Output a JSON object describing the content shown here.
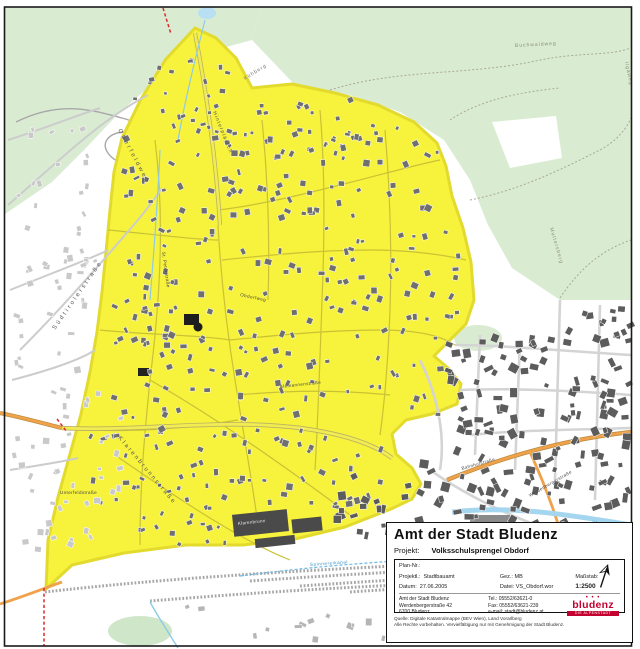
{
  "map": {
    "colors": {
      "district_fill": "#f7f23c",
      "district_border": "#e3da2e",
      "forest_green": "#d9ecd2",
      "building_dark": "#5c5c5c",
      "building_mid": "#6f6f6f",
      "building_light": "#c9c9c9",
      "main_road_orange": "#efa24a",
      "water_blue": "#a5d6ef",
      "boundary_red": "#dd2a2a"
    },
    "labels": [
      {
        "text": "Oberfeldweg",
        "x": 118,
        "y": 130,
        "r": 62,
        "s": 6,
        "sp": 2.5,
        "c": "#555"
      },
      {
        "text": "Hinterplärsch",
        "x": 213,
        "y": 112,
        "r": 68,
        "s": 5,
        "sp": 1.2,
        "c": "#555"
      },
      {
        "text": "Kühberg",
        "x": 245,
        "y": 80,
        "r": -32,
        "s": 5,
        "sp": 1,
        "c": "#777"
      },
      {
        "text": "Buchwaldweg",
        "x": 515,
        "y": 47,
        "r": -3,
        "s": 5,
        "sp": 1,
        "c": "#8a8a78"
      },
      {
        "text": "Ilgaweg",
        "x": 625,
        "y": 62,
        "r": 78,
        "s": 5,
        "sp": 1,
        "c": "#8a8a78"
      },
      {
        "text": "Muttersberg",
        "x": 550,
        "y": 228,
        "r": 74,
        "s": 5,
        "sp": 1,
        "c": "#8a8a78"
      },
      {
        "text": "Südtirolerstraße",
        "x": 55,
        "y": 330,
        "r": -55,
        "s": 6,
        "sp": 2.5,
        "c": "#555"
      },
      {
        "text": "Klarenbrunnstraße",
        "x": 118,
        "y": 438,
        "r": 50,
        "s": 6,
        "sp": 2.2,
        "c": "#555"
      },
      {
        "text": "Unterfeldstraße",
        "x": 60,
        "y": 494,
        "r": 0,
        "s": 4.5,
        "sp": 0.4,
        "c": "#444"
      },
      {
        "text": "Obdorfweg",
        "x": 240,
        "y": 296,
        "r": 12,
        "s": 4.5,
        "sp": 0.5,
        "c": "#444"
      },
      {
        "text": "Alemannenstraße",
        "x": 280,
        "y": 388,
        "r": -6,
        "s": 4.5,
        "sp": 0.4,
        "c": "#444"
      },
      {
        "text": "St. Peterstraße",
        "x": 162,
        "y": 252,
        "r": 82,
        "s": 4.5,
        "sp": 0.4,
        "c": "#444"
      },
      {
        "text": "Bahnhofstraße",
        "x": 462,
        "y": 470,
        "r": -16,
        "s": 4.5,
        "sp": 0.4,
        "c": "#444"
      },
      {
        "text": "Werdenbergerstraße",
        "x": 530,
        "y": 497,
        "r": -30,
        "s": 4.5,
        "sp": 0.4,
        "c": "#444"
      },
      {
        "text": "Spinnereikanal",
        "x": 310,
        "y": 566,
        "r": -4,
        "s": 4.5,
        "sp": 0.6,
        "c": "#3f8fc4"
      },
      {
        "text": "Ill",
        "x": 592,
        "y": 524,
        "r": 8,
        "s": 5,
        "sp": 0.5,
        "c": "#3f8fc4"
      },
      {
        "text": "Klarenbrunn",
        "x": 238,
        "y": 525,
        "r": -6,
        "s": 4.5,
        "sp": 0.3,
        "c": "#e8e8e8"
      }
    ]
  },
  "title_block": {
    "agency": "Amt der Stadt Bludenz",
    "projekt_label": "Projekt:",
    "projekt_value": "Volksschulsprengel Obdorf",
    "plan_label": "Plan-Nr.:",
    "f1l": "Projektl.:",
    "f1v": "Stadtbauamt",
    "f2l": "Gez.:",
    "f2v": "MB",
    "f3l": "Maßstab:",
    "d1l": "Datum:",
    "d1v": "27.06.2005",
    "d2l": "Datei:",
    "d2v": "VS_Obdorf.wor",
    "scale": "1:2500",
    "a1": "Amt der Stadt Bludenz",
    "a2": "Werdenbergerstraße 42",
    "a3": "6700 Bludenz",
    "c1": "Tel.: 05552/63621-0",
    "c2": "Fax: 05552/63621-239",
    "c3": "e-mail: stadt@bludenz.at",
    "logo_text": "bludenz",
    "logo_dots": "• • •",
    "logo_sub": "DIE ALPENSTADT",
    "footer1": "Quelle: Digitale Katastralmappe (BEV Wien), Land Vorarlberg",
    "footer2": "Alle Rechte vorbehalten. Vervielfältigung nur mit Genehmigung der Stadt Bludenz."
  }
}
